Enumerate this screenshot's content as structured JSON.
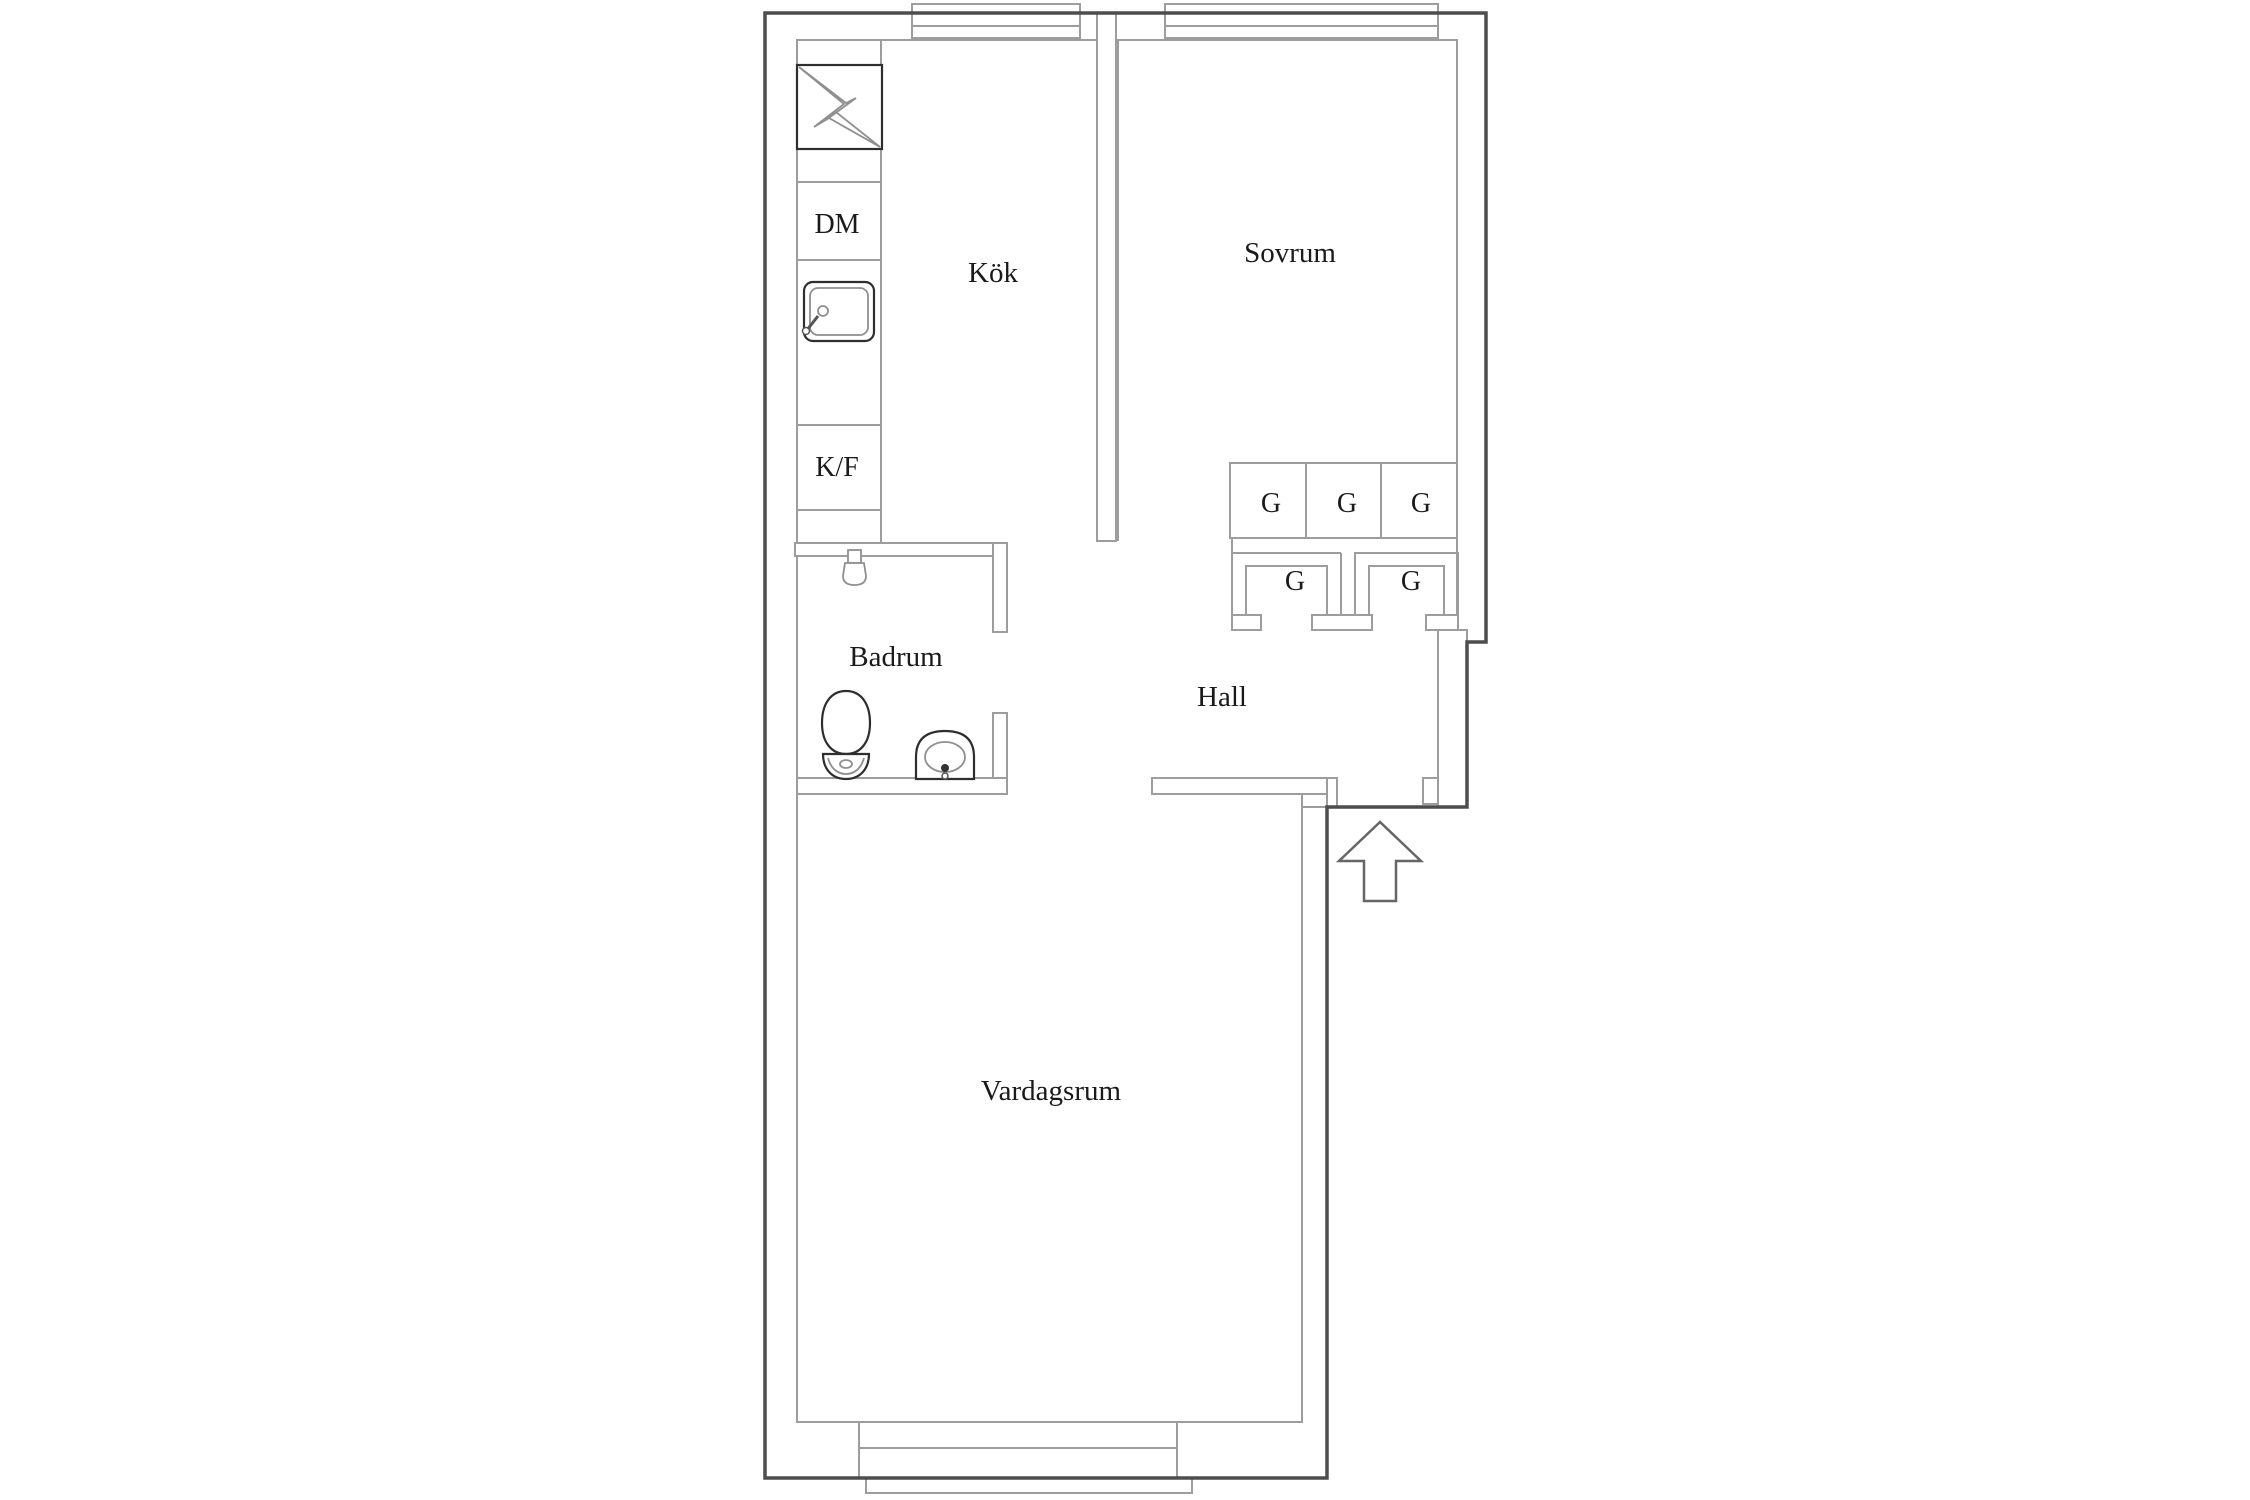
{
  "floorplan": {
    "rooms": {
      "kitchen": "Kök",
      "bedroom": "Sovrum",
      "bathroom": "Badrum",
      "hall": "Hall",
      "living_room": "Vardagsrum"
    },
    "appliances": {
      "dishwasher": "DM",
      "fridge_freezer": "K/F"
    },
    "wardrobes": [
      "G",
      "G",
      "G",
      "G",
      "G"
    ],
    "colors": {
      "background": "#ffffff",
      "wall_outline_dark": "#4d4d4d",
      "interior_line_light": "#9d9d9d",
      "fixture_dark": "#2e2e2e",
      "fixture_light": "#8f8f8f",
      "text": "#1a1a1a"
    }
  }
}
